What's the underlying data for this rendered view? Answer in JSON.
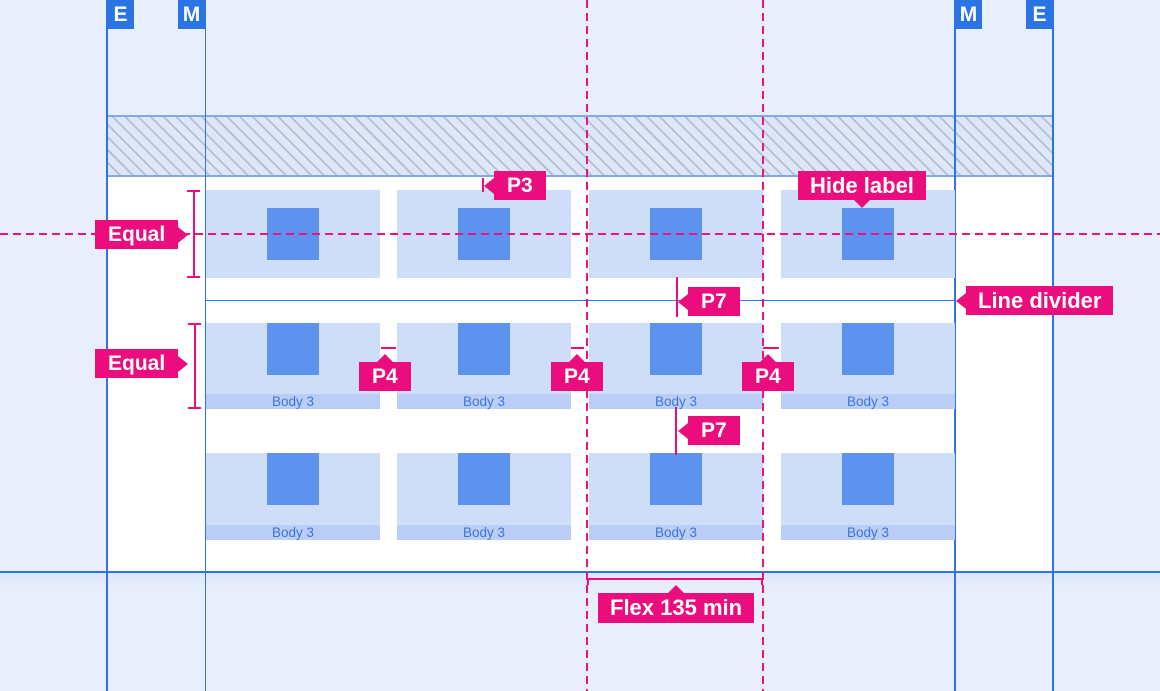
{
  "diagram": {
    "badges": {
      "left_outer": "E",
      "left_inner": "M",
      "right_inner": "M",
      "right_outer": "E"
    },
    "annotations": {
      "equal_top": "Equal",
      "equal_bottom": "Equal",
      "p3": "P3",
      "p4_left": "P4",
      "p4_middle": "P4",
      "p4_right": "P4",
      "p7_upper": "P7",
      "p7_lower": "P7",
      "hide_label": "Hide label",
      "line_divider": "Line divider",
      "flex_min": "Flex 135 min"
    },
    "cards": {
      "footer_label": "Body 3"
    },
    "colors": {
      "background": "#e8eefb",
      "sheet": "#ffffff",
      "annotation_pink": "#eb0c7d",
      "badge_blue": "#2a74e4",
      "guide_line_blue": "#2a74e6",
      "divider_blue": "#2e7de2",
      "card_fill": "#cedef9",
      "card_square": "#5e92ef",
      "card_footer_fill": "#bacdf5",
      "card_footer_text": "#3c74da",
      "hatch_fill": "#dde7f7",
      "hatch_border": "#7fa9e7"
    }
  }
}
